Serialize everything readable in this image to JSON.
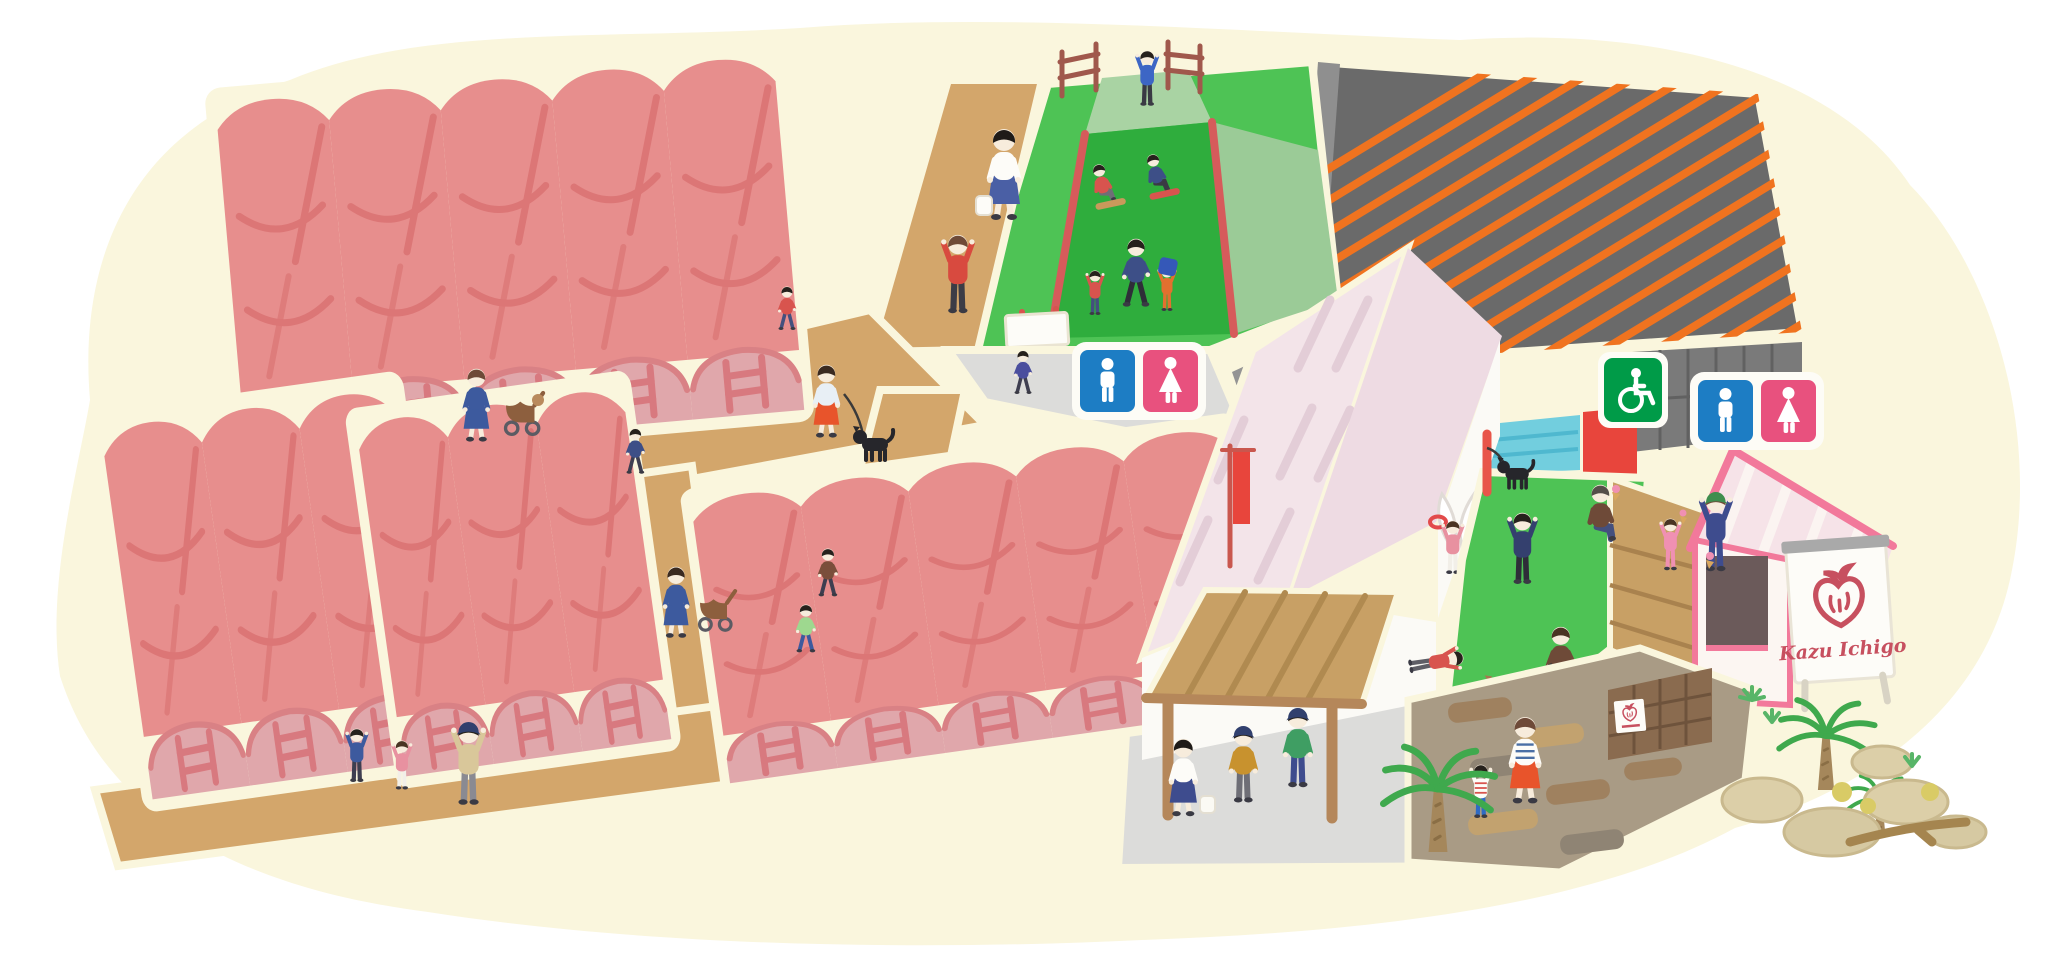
{
  "farm_sign": {
    "text": "Kazu Ichigo",
    "logo": "strawberry-logo-icon",
    "text_color": "#c7505f"
  },
  "pictograms": {
    "accessible": {
      "icon": "wheelchair-icon",
      "bg": "#009b48"
    },
    "restroom_men": {
      "icon": "men-restroom-icon",
      "bg": "#1d7dc4"
    },
    "restroom_women": {
      "icon": "women-restroom-icon",
      "bg": "#e8517e"
    }
  },
  "palette": {
    "canvas": "#ffffff",
    "ground_cream": "#faf6dd",
    "greenhouse_roof": "#e78e8d",
    "greenhouse_wall": "#e0a7ab",
    "greenhouse_line": "#dc7676",
    "path_tan": "#d3a66b",
    "grass_green": "#4ec355",
    "slide_green": "#2fad3d",
    "hill_side_green": "#9bcb97",
    "parking_gray": "#6a6a6a",
    "parking_stripe_orange": "#f0731f",
    "barn_roof_pink": "#f3e4e9",
    "concrete_gray": "#dcdcda",
    "pergola_wood": "#c8a065",
    "kiosk_trim_pink": "#f2799b",
    "rail_red": "#d65b5b"
  }
}
